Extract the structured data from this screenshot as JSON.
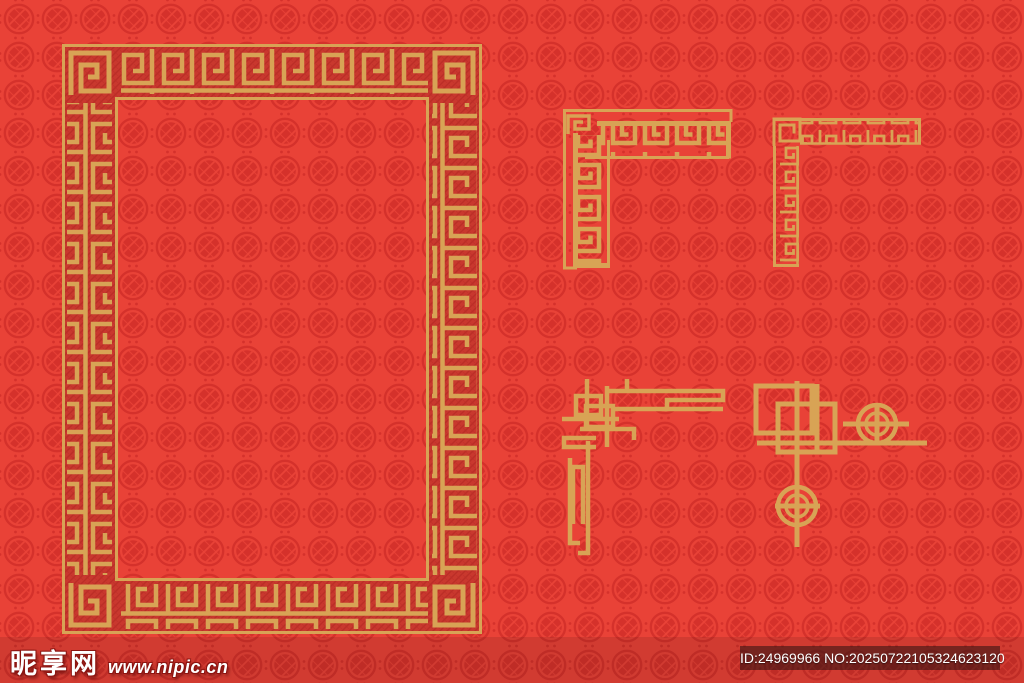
{
  "canvas": {
    "width": 1024,
    "height": 683
  },
  "watermark": {
    "site_name": "昵享网",
    "site_url": "www.nipic.cn"
  },
  "id_badge": {
    "text": "ID:24969966 NO:20250722105324623120"
  },
  "colors": {
    "background_red": "#e94237",
    "pattern_red": "#d5312b",
    "frame_band_red": "#c9382e",
    "band_hatch_red": "#bb2e27",
    "gold": "#d8a355",
    "badge_bg": "rgba(43,18,16,0.55)",
    "watermark_text": "#ffffff"
  },
  "background_motif": "chinese-coin-knot-circle-pattern",
  "ornaments": [
    {
      "name": "greek-key-rectangular-frame"
    },
    {
      "name": "greek-key-corner-border"
    },
    {
      "name": "fine-fret-corner-border"
    },
    {
      "name": "interlocked-line-corner-border"
    },
    {
      "name": "coin-and-line-corner-border"
    }
  ]
}
